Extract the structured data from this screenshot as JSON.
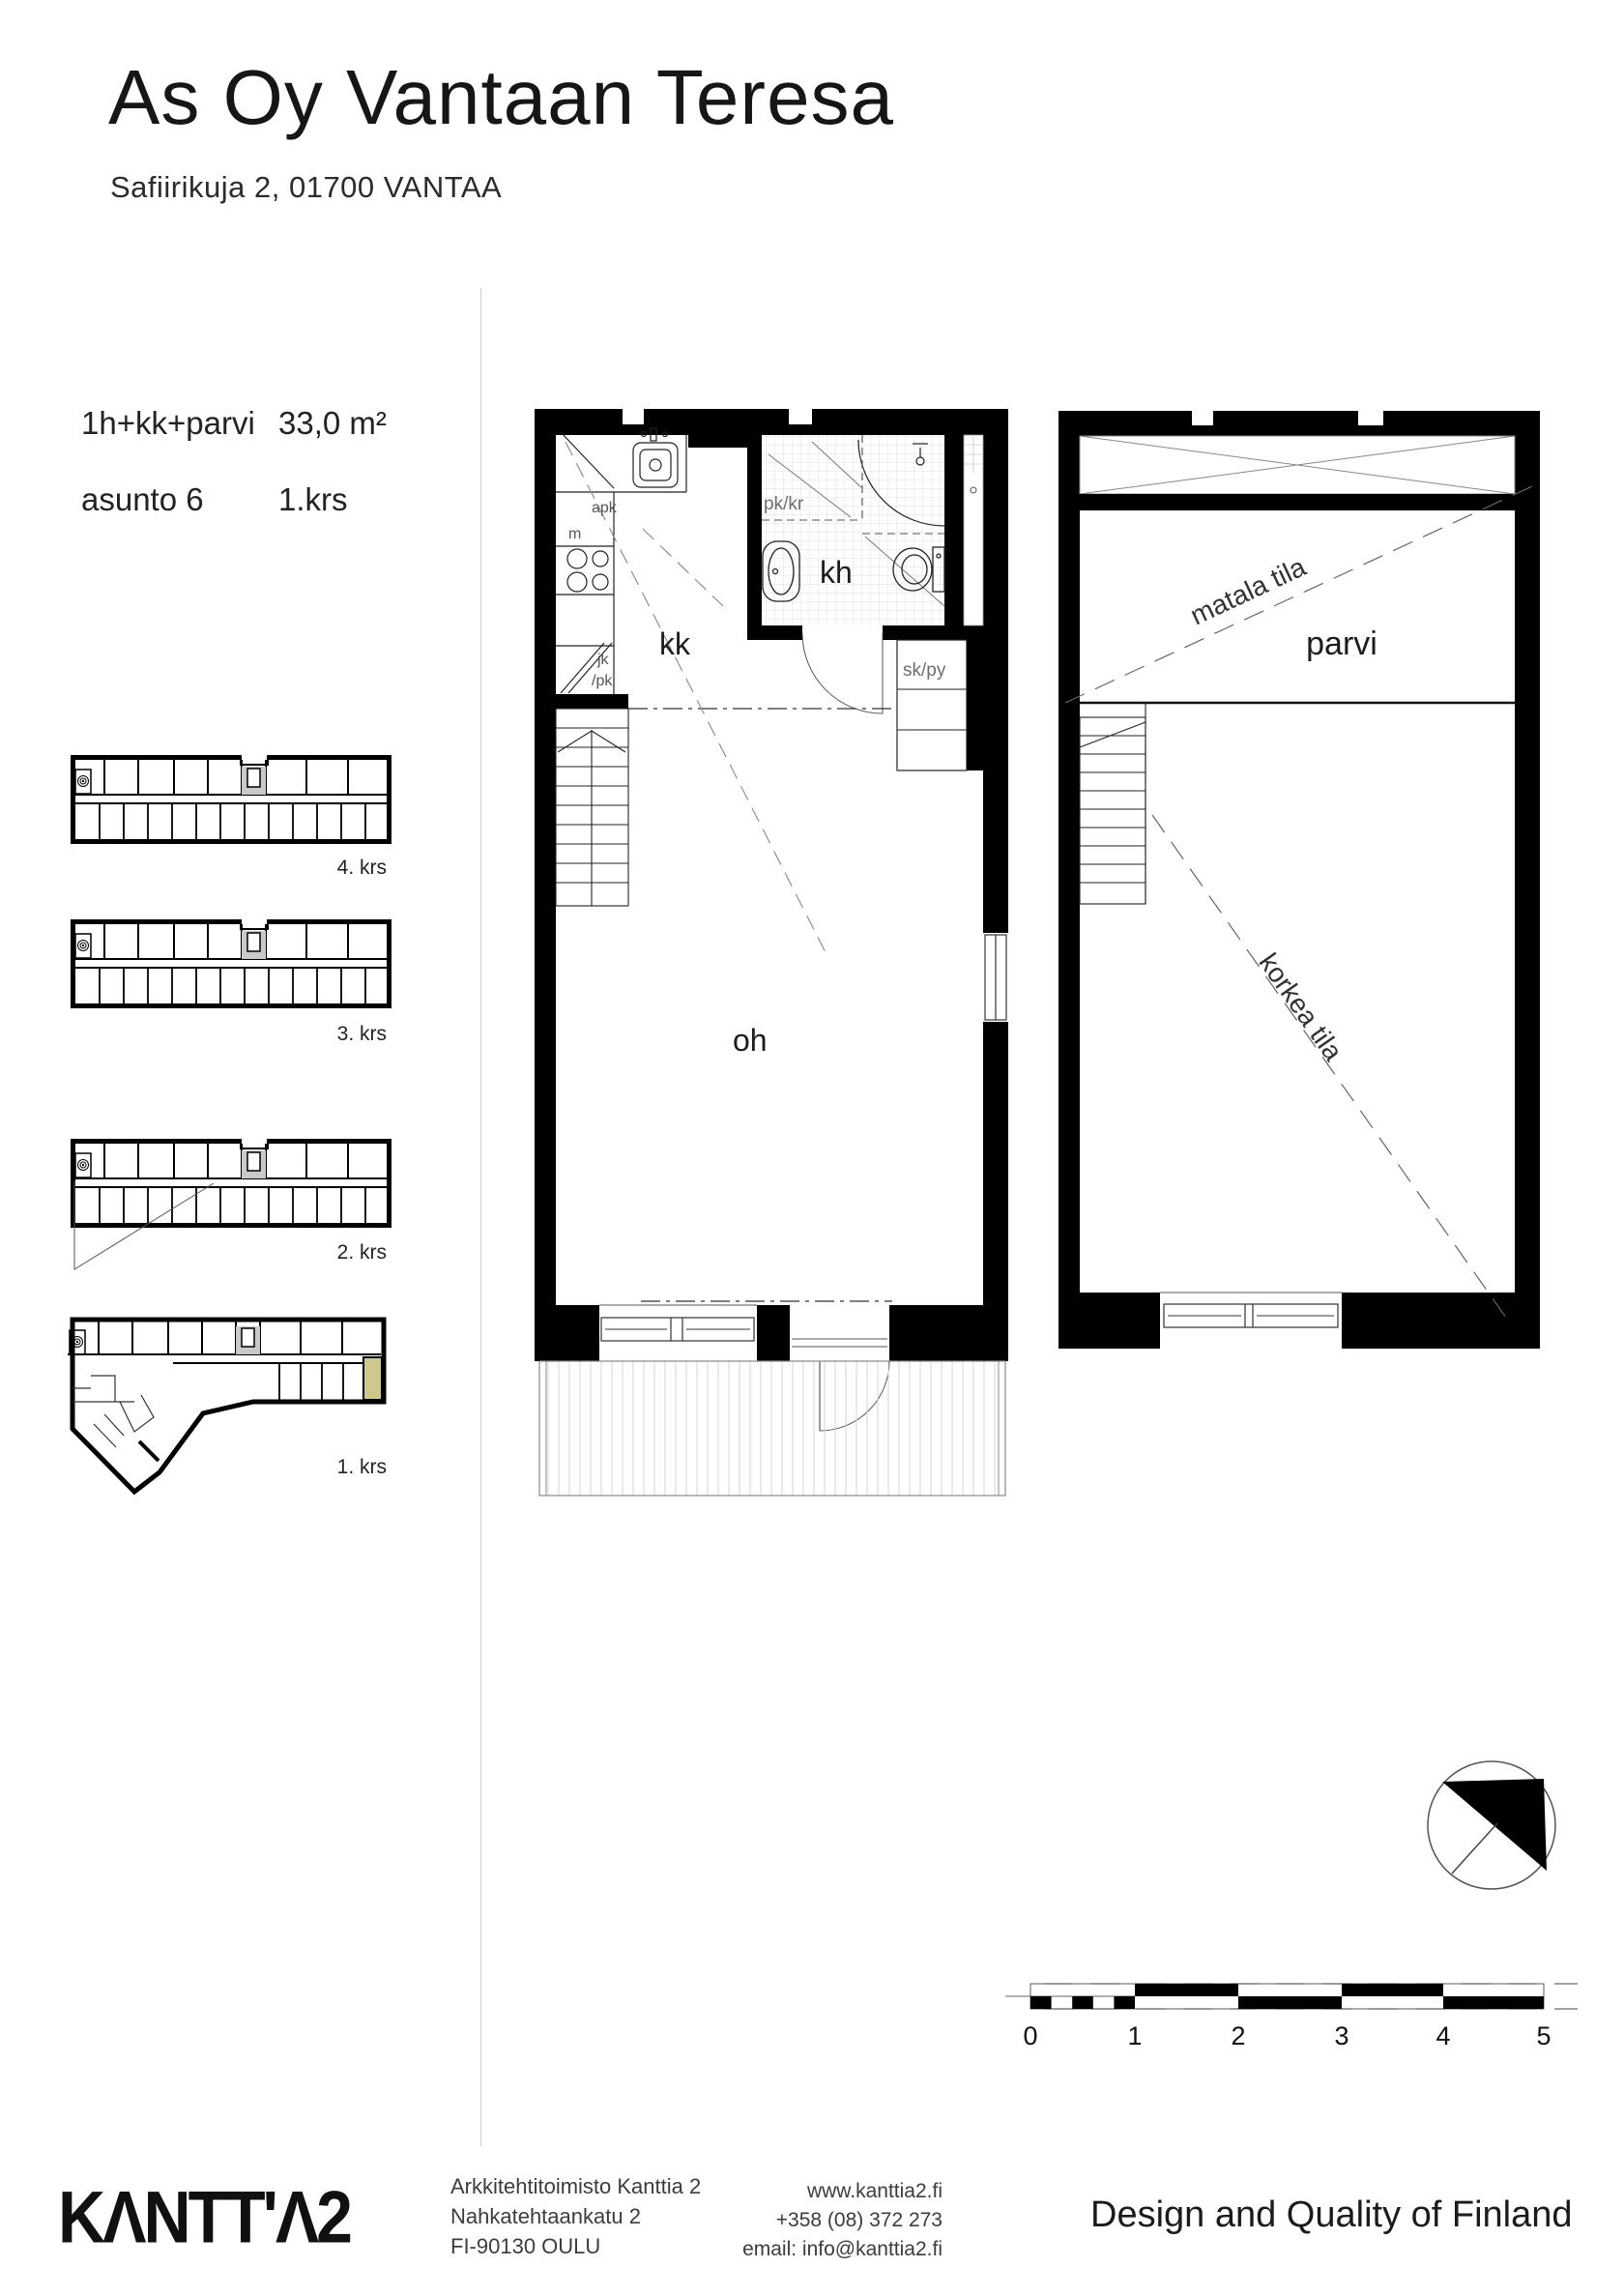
{
  "header": {
    "title": "As Oy Vantaan Teresa",
    "subtitle": "Safiirikuja 2, 01700 VANTAA"
  },
  "apartment": {
    "type": "1h+kk+parvi",
    "area": "33,0 m²",
    "unit": "asunto 6",
    "floor": "1.krs"
  },
  "overview": {
    "labels": [
      "4. krs",
      "3. krs",
      "2. krs",
      "1. krs"
    ],
    "highlight_color": "#cdc78a"
  },
  "plan1": {
    "labels": {
      "kk": "kk",
      "kh": "kh",
      "oh": "oh",
      "skpy": "sk/py",
      "pkkr": "pk/kr",
      "apk": "apk",
      "m": "m",
      "jk": "jk",
      "pk": "/pk"
    }
  },
  "plan2": {
    "labels": {
      "matala": "matala tila",
      "parvi": "parvi",
      "korkea": "korkea tila"
    }
  },
  "scale_bar": {
    "ticks": [
      "0",
      "1",
      "2",
      "3",
      "4",
      "5"
    ]
  },
  "colors": {
    "wall": "#000000",
    "highlight": "#cdc78a"
  },
  "footer": {
    "logo": "KΛNTT'Λ2",
    "address": [
      "Arkkitehtitoimisto Kanttia 2",
      "Nahkatehtaankatu 2",
      "FI-90130 OULU"
    ],
    "contact": [
      "www.kanttia2.fi",
      "+358 (08) 372 273",
      "email: info@kanttia2.fi"
    ],
    "tagline": "Design and Quality of Finland"
  }
}
